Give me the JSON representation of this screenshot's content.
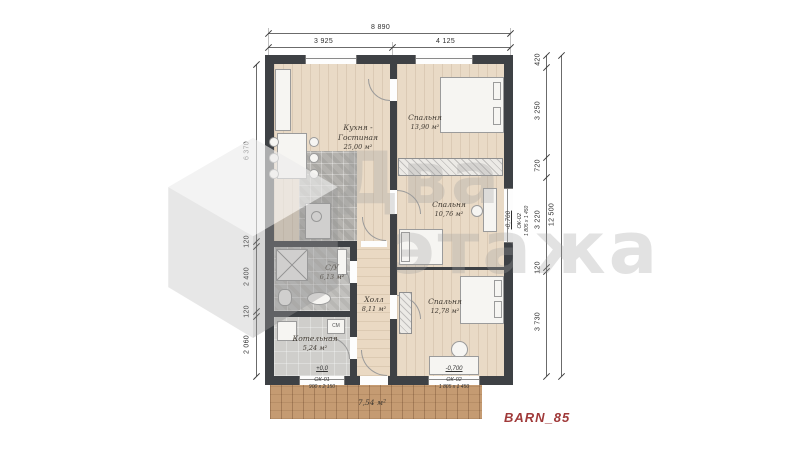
{
  "project": {
    "label": "BARN_85"
  },
  "watermark": {
    "word1": "Два",
    "word2": "этажа"
  },
  "colors": {
    "accent_red": "#a03a3a",
    "wall": "#3e4145",
    "wood_floor": "#e9dac6",
    "deck_wood": "#c59b72"
  },
  "dims": {
    "top_total": "8 890",
    "top_left": "3 925",
    "top_right": "4 125",
    "left": [
      "6 370",
      "120",
      "2 400",
      "120",
      "2 060"
    ],
    "right": [
      "420",
      "3 250",
      "720",
      "3 220",
      "120",
      "3 730"
    ],
    "right_total": "12 500"
  },
  "rooms": {
    "kitchen": {
      "name1": "Кухня -",
      "name2": "Гостиная",
      "area": "25,00 м²"
    },
    "bedroom1": {
      "name": "Спальня",
      "area": "13,90 м²"
    },
    "bedroom2": {
      "name": "Спальня",
      "area": "10,76 м²"
    },
    "hall": {
      "name": "Холл",
      "area": "8,11 м²"
    },
    "bathroom": {
      "name": "С/У",
      "area": "6,13 м²"
    },
    "boiler": {
      "name": "Котельная",
      "area": "5,24 м²"
    },
    "bedroom3": {
      "name": "Спальня",
      "area": "12,78 м²"
    },
    "terrace": {
      "area": "7,54 м²"
    }
  },
  "levels": {
    "entry": "+0,0",
    "terrace": "-0,700",
    "right": "-0,700"
  },
  "windows": {
    "ok01": {
      "code": "ОК-01",
      "size": "900 х 2 150"
    },
    "ok02_bottom": {
      "code": "ОК-02",
      "size": "1 805 х 1 450"
    },
    "ok02_right": {
      "code": "ОК-02",
      "size": "1 805 х 1 450"
    }
  },
  "appliances": {
    "washer": "СМ"
  }
}
